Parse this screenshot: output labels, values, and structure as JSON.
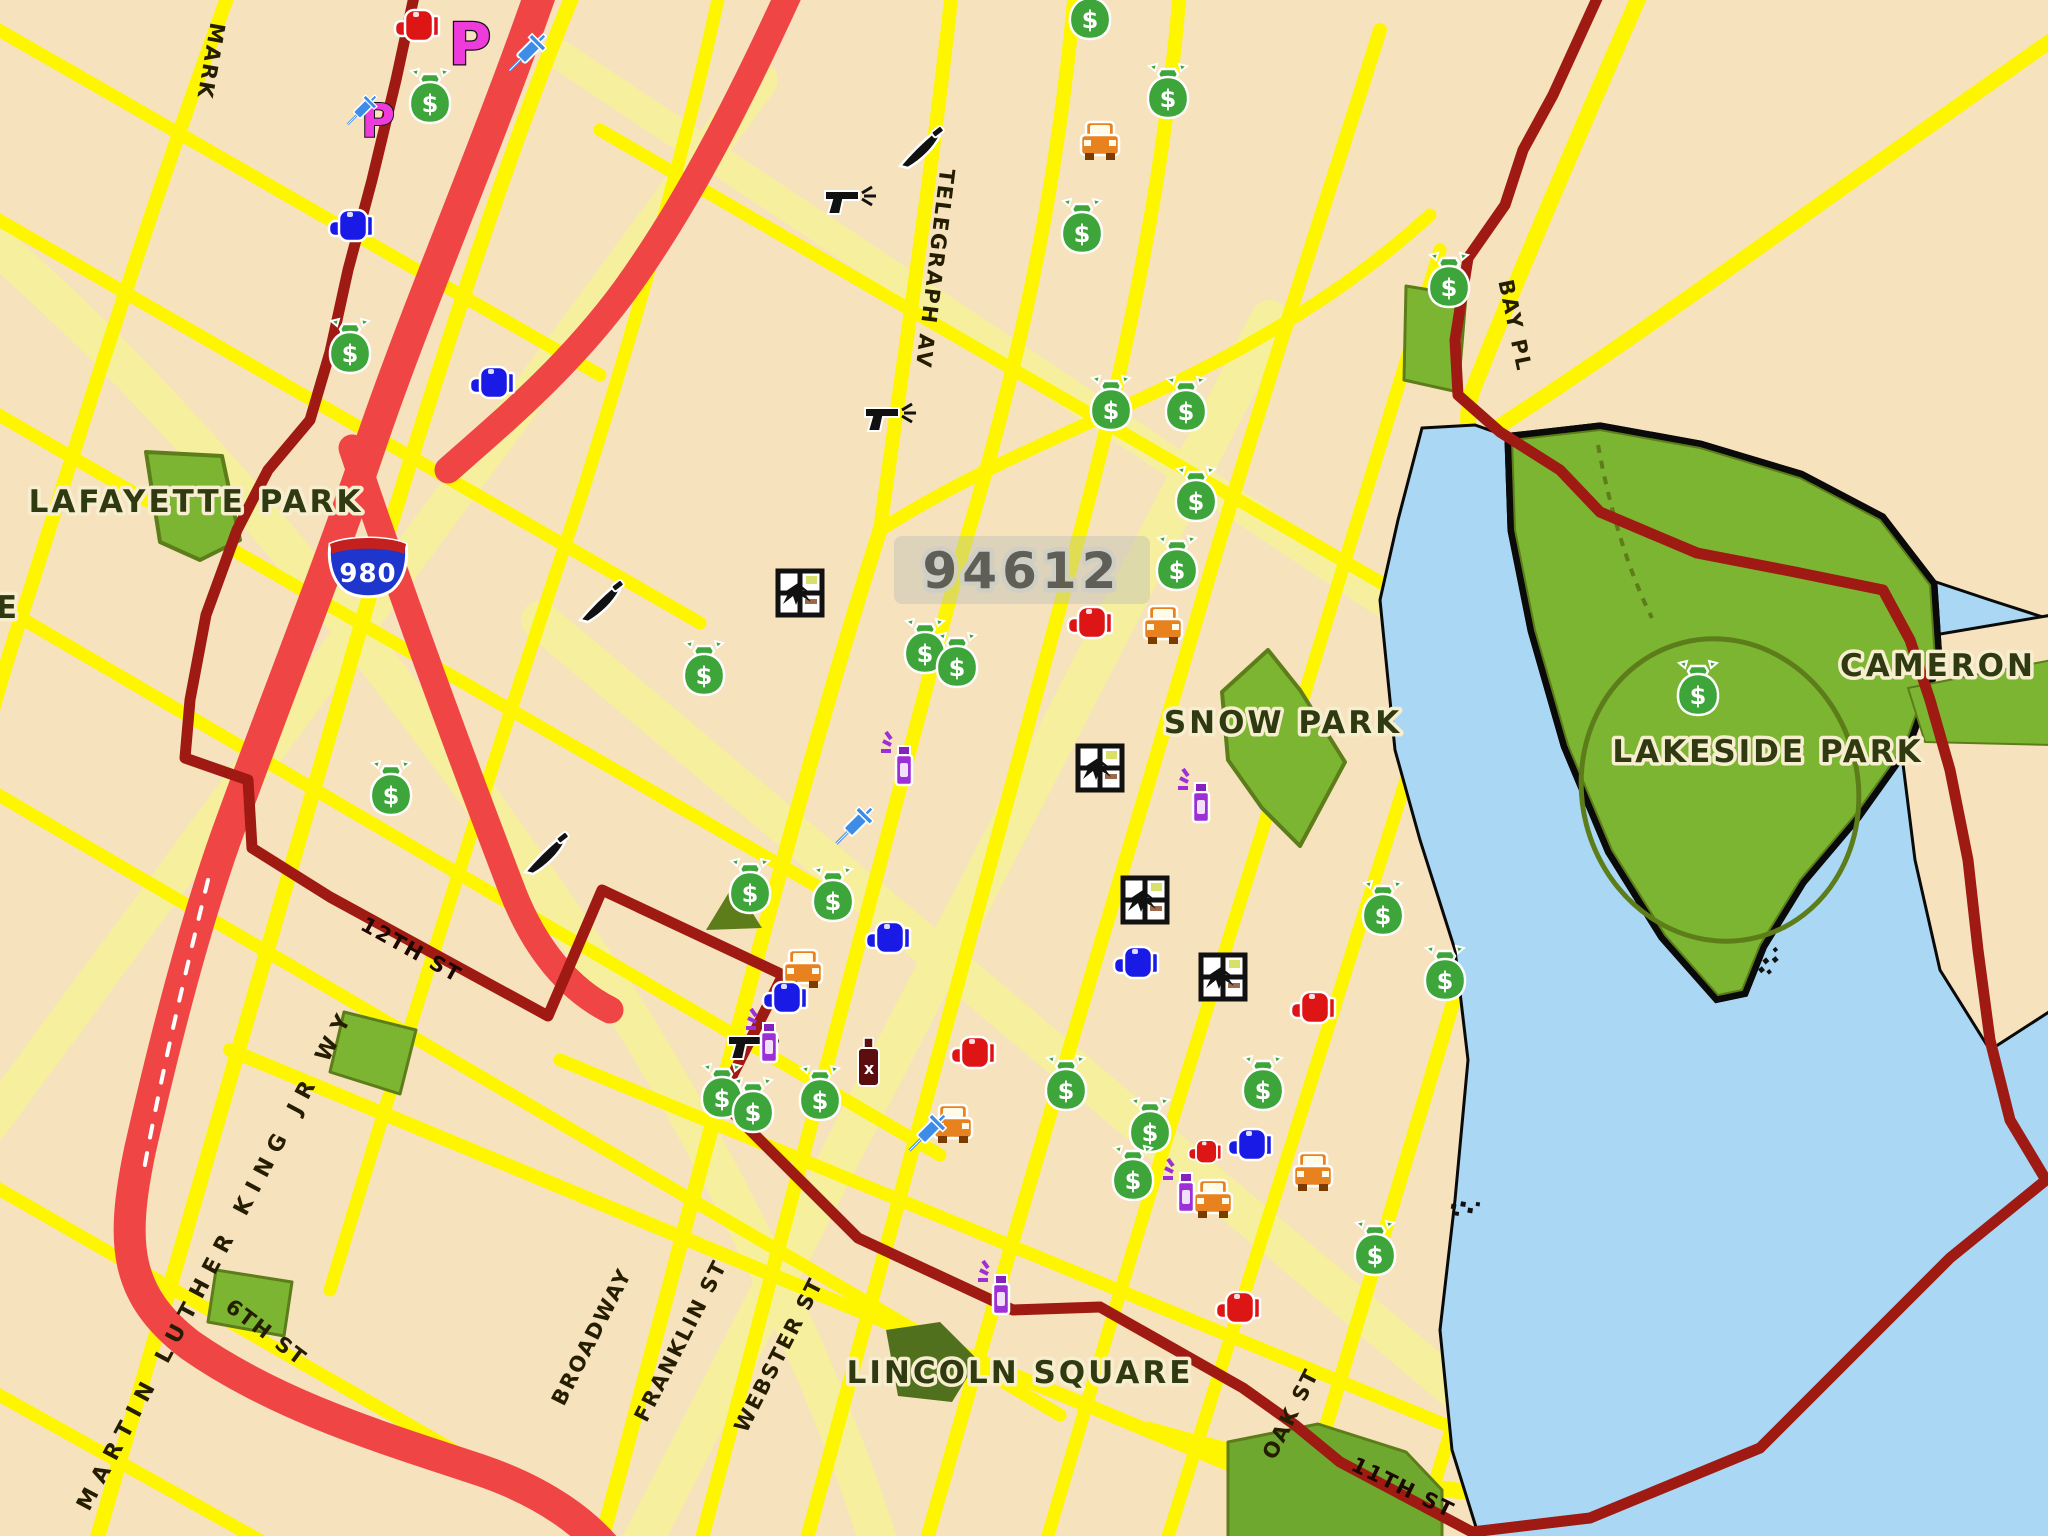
{
  "map": {
    "zip_label": {
      "text": "94612",
      "x": 1022,
      "y": 588
    },
    "interstate_shield": {
      "number": "980",
      "x": 368,
      "y": 572,
      "colors": {
        "body": "#1E36CC",
        "top": "#C42020",
        "text": "#ffffff"
      }
    },
    "labels": [
      {
        "id": "street-market-partial",
        "text": "MARK",
        "x": 204,
        "y": 60,
        "rot": 100,
        "cls": "lbl-street"
      },
      {
        "id": "street-telegraph",
        "text": "TELEGRAPH AV",
        "x": 928,
        "y": 268,
        "rot": 97,
        "cls": "lbl-street"
      },
      {
        "id": "street-bay-pl",
        "text": "BAY PL",
        "x": 1508,
        "y": 327,
        "rot": 78,
        "cls": "lbl-street"
      },
      {
        "id": "street-mlk",
        "text": "MARTIN LUTHER KING JR WY",
        "x": 222,
        "y": 1262,
        "rot": -62,
        "cls": "lbl-street-long"
      },
      {
        "id": "street-broadway",
        "text": "BROADWAY",
        "x": 598,
        "y": 1340,
        "rot": -63,
        "cls": "lbl-street"
      },
      {
        "id": "street-franklin",
        "text": "FRANKLIN ST",
        "x": 687,
        "y": 1344,
        "rot": -63,
        "cls": "lbl-street"
      },
      {
        "id": "street-webster",
        "text": "WEBSTER ST",
        "x": 785,
        "y": 1358,
        "rot": -63,
        "cls": "lbl-street"
      },
      {
        "id": "street-oak",
        "text": "OAK ST",
        "x": 1297,
        "y": 1417,
        "rot": -63,
        "cls": "lbl-street"
      },
      {
        "id": "street-11th",
        "text": "11TH ST",
        "x": 1400,
        "y": 1494,
        "rot": 26,
        "cls": "lbl-onred"
      },
      {
        "id": "street-12th",
        "text": "12TH ST",
        "x": 408,
        "y": 956,
        "rot": 29,
        "cls": "lbl-onred"
      },
      {
        "id": "street-6th",
        "text": "6TH ST",
        "x": 262,
        "y": 1338,
        "rot": 37,
        "cls": "lbl-street"
      },
      {
        "id": "park-lafayette",
        "text": "LAFAYETTE PARK",
        "x": 196,
        "y": 512,
        "rot": 0,
        "cls": "lbl-park"
      },
      {
        "id": "park-snow",
        "text": "SNOW PARK",
        "x": 1283,
        "y": 733,
        "rot": 0,
        "cls": "lbl-park"
      },
      {
        "id": "park-lakeside",
        "text": "LAKESIDE PARK",
        "x": 1768,
        "y": 762,
        "rot": 0,
        "cls": "lbl-park"
      },
      {
        "id": "area-cameron-partial",
        "text": "CAMERON",
        "x": 1938,
        "y": 676,
        "rot": 0,
        "cls": "lbl-park"
      },
      {
        "id": "park-lincoln-square",
        "text": "LINCOLN SQUARE",
        "x": 1020,
        "y": 1383,
        "rot": 0,
        "cls": "lbl-park"
      },
      {
        "id": "label-fragment-left-edge",
        "text": "E",
        "x": 8,
        "y": 618,
        "rot": 0,
        "cls": "lbl-park"
      }
    ],
    "icons": [
      {
        "type": "money-bag",
        "x": 430,
        "y": 98
      },
      {
        "type": "money-bag",
        "x": 350,
        "y": 348
      },
      {
        "type": "money-bag",
        "x": 1090,
        "y": 14
      },
      {
        "type": "money-bag",
        "x": 1168,
        "y": 93
      },
      {
        "type": "money-bag",
        "x": 1082,
        "y": 228
      },
      {
        "type": "money-bag",
        "x": 1111,
        "y": 405
      },
      {
        "type": "money-bag",
        "x": 1186,
        "y": 406
      },
      {
        "type": "money-bag",
        "x": 1196,
        "y": 496
      },
      {
        "type": "money-bag",
        "x": 1177,
        "y": 565
      },
      {
        "type": "money-bag",
        "x": 925,
        "y": 648
      },
      {
        "type": "money-bag",
        "x": 957,
        "y": 662
      },
      {
        "type": "money-bag",
        "x": 704,
        "y": 670
      },
      {
        "type": "money-bag",
        "x": 391,
        "y": 790
      },
      {
        "type": "money-bag",
        "x": 750,
        "y": 888
      },
      {
        "type": "money-bag",
        "x": 833,
        "y": 896
      },
      {
        "type": "money-bag",
        "x": 722,
        "y": 1093
      },
      {
        "type": "money-bag",
        "x": 753,
        "y": 1107
      },
      {
        "type": "money-bag",
        "x": 820,
        "y": 1095
      },
      {
        "type": "money-bag",
        "x": 1066,
        "y": 1085
      },
      {
        "type": "money-bag",
        "x": 1150,
        "y": 1127
      },
      {
        "type": "money-bag",
        "x": 1133,
        "y": 1175
      },
      {
        "type": "money-bag",
        "x": 1263,
        "y": 1085
      },
      {
        "type": "money-bag",
        "x": 1375,
        "y": 1250
      },
      {
        "type": "money-bag",
        "x": 1383,
        "y": 910
      },
      {
        "type": "money-bag",
        "x": 1445,
        "y": 975
      },
      {
        "type": "money-bag",
        "x": 1698,
        "y": 690
      },
      {
        "type": "money-bag",
        "x": 1449,
        "y": 282
      },
      {
        "type": "burglary-window",
        "x": 800,
        "y": 593
      },
      {
        "type": "burglary-window",
        "x": 1100,
        "y": 768
      },
      {
        "type": "burglary-window",
        "x": 1145,
        "y": 900
      },
      {
        "type": "burglary-window",
        "x": 1223,
        "y": 977
      },
      {
        "type": "car-theft",
        "x": 1100,
        "y": 142
      },
      {
        "type": "car-theft",
        "x": 1163,
        "y": 626
      },
      {
        "type": "car-theft",
        "x": 803,
        "y": 970
      },
      {
        "type": "glove-blue",
        "x": 351,
        "y": 226
      },
      {
        "type": "glove-blue",
        "x": 492,
        "y": 383
      },
      {
        "type": "gun",
        "x": 845,
        "y": 203
      },
      {
        "type": "gun",
        "x": 885,
        "y": 420
      },
      {
        "type": "knife",
        "x": 918,
        "y": 150
      },
      {
        "type": "knife",
        "x": 598,
        "y": 604
      },
      {
        "type": "knife",
        "x": 543,
        "y": 856
      },
      {
        "type": "bottle",
        "x": 868,
        "y": 1062
      },
      {
        "type": "glove-red",
        "x": 1090,
        "y": 623
      },
      {
        "type": "glove-red",
        "x": 973,
        "y": 1053
      },
      {
        "type": "glove-red",
        "x": 1313,
        "y": 1008
      },
      {
        "type": "glove-red",
        "x": 1238,
        "y": 1308
      },
      {
        "type": "car-theft",
        "x": 1213,
        "y": 1200
      },
      {
        "type": "spray-can",
        "x": 1185,
        "y": 1190
      },
      {
        "type": "glove-red",
        "x": 1205,
        "y": 1152,
        "scale": 0.75
      },
      {
        "type": "glove-blue",
        "x": 1250,
        "y": 1145
      },
      {
        "type": "glove-blue",
        "x": 1136,
        "y": 963
      },
      {
        "type": "glove-blue",
        "x": 888,
        "y": 938
      },
      {
        "type": "glove-blue",
        "x": 785,
        "y": 998
      },
      {
        "type": "gun",
        "x": 748,
        "y": 1048
      },
      {
        "type": "spray-can",
        "x": 768,
        "y": 1040
      },
      {
        "type": "spray-can",
        "x": 903,
        "y": 763
      },
      {
        "type": "spray-can",
        "x": 1200,
        "y": 800
      },
      {
        "type": "spray-can",
        "x": 1000,
        "y": 1292
      },
      {
        "type": "car-theft",
        "x": 953,
        "y": 1125
      },
      {
        "type": "syringe",
        "x": 925,
        "y": 1135
      },
      {
        "type": "car-theft",
        "x": 1313,
        "y": 1173
      },
      {
        "type": "syringe",
        "x": 852,
        "y": 828
      },
      {
        "type": "p-letter",
        "x": 378,
        "y": 122,
        "scale": 0.8
      },
      {
        "type": "syringe",
        "x": 360,
        "y": 112,
        "scale": 0.8
      },
      {
        "type": "p-letter",
        "x": 470,
        "y": 46
      },
      {
        "type": "syringe",
        "x": 525,
        "y": 55
      },
      {
        "type": "glove-red",
        "x": 417,
        "y": 26
      },
      {
        "type": "tiny-marks",
        "x": 1770,
        "y": 962,
        "rot": -40
      },
      {
        "type": "tiny-marks",
        "x": 1465,
        "y": 1208,
        "rot": 10
      }
    ],
    "colors": {
      "land": "#F6E2BD",
      "street_major": "#FEF600",
      "street_minor": "#F6EF9E",
      "freeway": "#F04545",
      "boundary": "#9E1A12",
      "park": "#7CB531",
      "park_dark": "#5C7D1A",
      "park_dull": "#50701E",
      "water": "#AAD8F4",
      "shore": "#0a0a0a",
      "icon_money": "#3DA53A",
      "icon_glove_blue": "#1A1AE6",
      "icon_glove_red": "#DD1515",
      "icon_gun": "#111111",
      "icon_car": "#E8821E",
      "icon_spray": "#9C2FD6",
      "icon_p": "#EE3CDC",
      "icon_syringe": "#3C8CE8",
      "icon_bottle": "#5C0E0E"
    }
  }
}
